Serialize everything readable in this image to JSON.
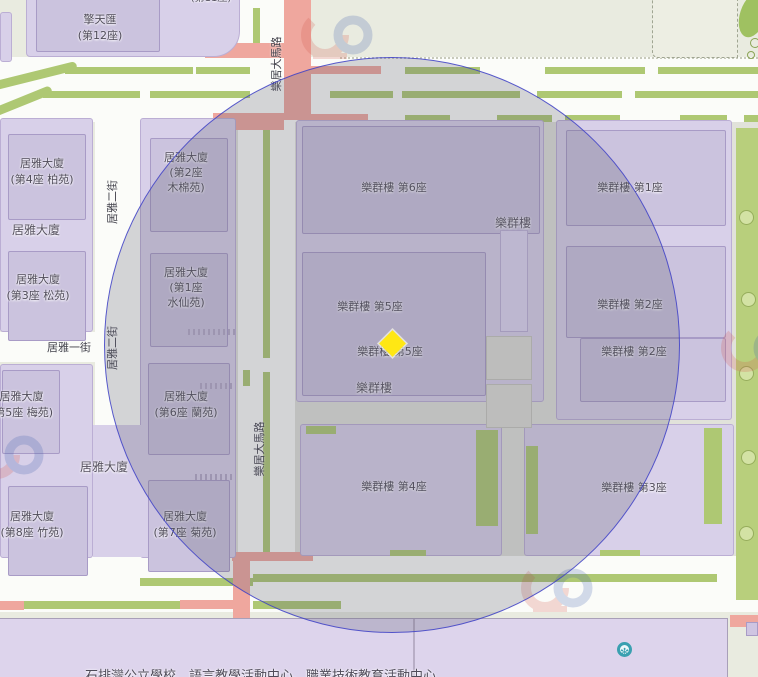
{
  "labels": {
    "sky_oasis": [
      "擎天匯",
      "(第12座)"
    ],
    "sky_oasis_partial": "(第11座)",
    "koi_nga_area": "居雅大廈",
    "koi_nga_4": [
      "居雅大廈",
      "(第4座 柏苑)"
    ],
    "koi_nga_3": [
      "居雅大廈",
      "(第3座 松苑)"
    ],
    "koi_nga_5": [
      "居雅大廈",
      "(第5座 梅苑)"
    ],
    "koi_nga_8": [
      "居雅大廈",
      "(第8座 竹苑)"
    ],
    "koi_nga_7": [
      "居雅大廈",
      "(第7座 菊苑)"
    ],
    "koi_nga_2": [
      "居雅大廈",
      "(第2座",
      "木棉苑)"
    ],
    "koi_nga_1": [
      "居雅大廈",
      "(第1座",
      "水仙苑)"
    ],
    "koi_nga_6": [
      "居雅大廈",
      "(第6座 蘭苑)"
    ],
    "lok_kwan_area": "樂群樓",
    "lok_kwan_1": "樂群樓 第1座",
    "lok_kwan_2": "樂群樓 第2座",
    "lok_kwan_3": "樂群樓 第3座",
    "lok_kwan_4": "樂群樓 第4座",
    "lok_kwan_5": "樂群樓 第5座",
    "lok_kwan_6": "樂群樓 第6座",
    "facility_note": "石排灣公立學校、語言教學活動中心、職業技術教育活動中心"
  },
  "streets": {
    "koi_nga_1st": "居雅一街",
    "koi_nga_2nd": "居雅二街",
    "lok_koi_avenue": "樂居大馬路"
  },
  "marker": {
    "shape": "diamond",
    "color": "#ffe714",
    "x": 392,
    "y": 343
  },
  "radius_circle": {
    "cx": 392,
    "cy": 345,
    "r": 288,
    "stroke": "#4042c8",
    "tint": "rgba(90,90,110,0.25)"
  },
  "icons": {
    "facility_icon": "snowflake-circle",
    "facility_icon_glyph": "✻"
  },
  "colors": {
    "background": "#e9ebe0",
    "road": "#fbfcf9",
    "building": "#d8d0e9",
    "tower": "#cbc3de",
    "green_strip": "#aec873",
    "red_road": "#efa79e",
    "school_block": "#ddd4ec",
    "marker_yellow": "#ffe714",
    "circle_stroke": "#4042c8",
    "facility_teal": "#3aa0b0"
  }
}
